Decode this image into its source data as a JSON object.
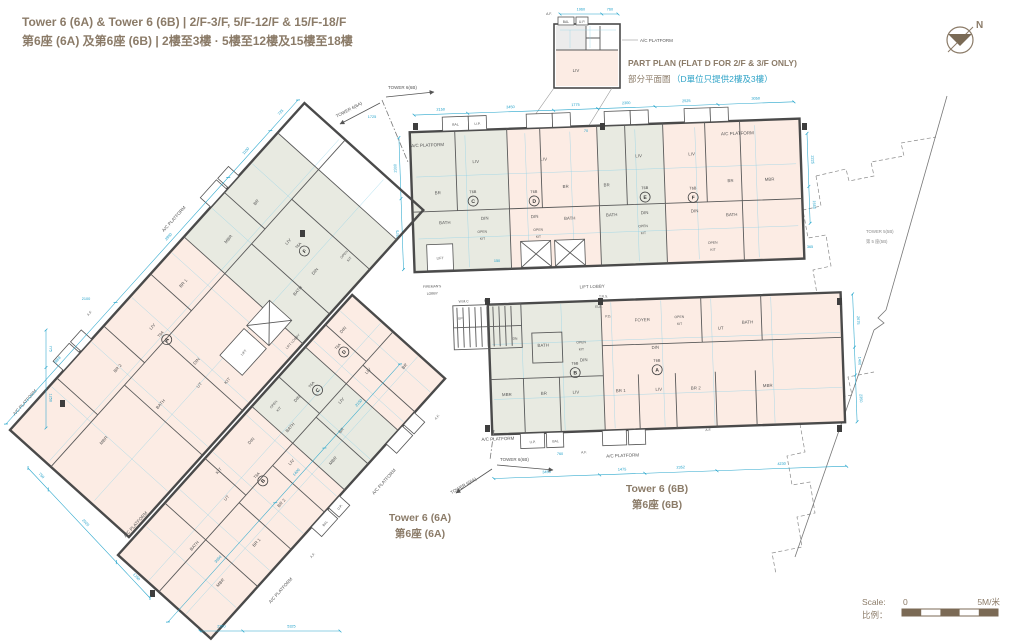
{
  "header": {
    "title_en": "Tower 6 (6A) & Tower 6 (6B) | 2/F-3/F,  5/F-12/F & 15/F-18/F",
    "title_zh": "第6座 (6A) 及第6座 (6B) | 2樓至3樓 · 5樓至12樓及15樓至18樓"
  },
  "part_plan": {
    "caption_en": "PART PLAN (FLAT D FOR 2/F & 3/F ONLY)",
    "caption_zh": "部分平面圖",
    "caption_zh_note": "（D單位只提供2樓及3樓）"
  },
  "compass": {
    "north": "N"
  },
  "towers": {
    "t6a": {
      "name_en": "Tower 6 (6A)",
      "name_zh": "第6座 (6A)",
      "code": "T6A",
      "marker": "TOWER 6(6A)",
      "units": [
        "A",
        "B",
        "C",
        "D",
        "F"
      ]
    },
    "t6b": {
      "name_en": "Tower 6 (6B)",
      "name_zh": "第6座 (6B)",
      "code": "T6B",
      "marker": "TOWER 6(6B)",
      "units": [
        "A",
        "B",
        "C",
        "D",
        "E",
        "F"
      ]
    }
  },
  "adjacent": {
    "name_en": "TOWER 5(5B)",
    "name_zh": "第 5 座(5B)"
  },
  "rooms": {
    "liv": "LIV",
    "din": "DIN",
    "br": "BR",
    "br1": "BR 1",
    "br2": "BR 2",
    "mbr": "MBR",
    "bath": "BATH",
    "open": "OPEN",
    "kit": "KIT",
    "ut": "UT",
    "foyer": "FOYER",
    "bal": "BAL",
    "up": "U.P.",
    "af": "A.F.",
    "ac": "A/C PLATFORM",
    "lift": "LIFT",
    "lift_lobby": "LIFT LOBBY",
    "fireman1": "FIREMAN'S",
    "fireman2": "LOBBY",
    "ele": "ELE.",
    "trs": "T.R.S.",
    "pd": "P.D.",
    "wmc": "W.M.C",
    "hr": "H.R.",
    "up_dir": "UP",
    "dn_dir": "DN"
  },
  "dims": {
    "c1": [
      2150,
      3450,
      1775,
      2300,
      2525,
      3050
    ],
    "c2": [
      2675,
      1400,
      2350
    ],
    "c3": [
      3450,
      1475,
      2352,
      4230
    ],
    "c4": [
      750,
      2525,
      1250
    ],
    "c5": [
      2868,
      2950,
      1100,
      725
    ],
    "c6": [
      3050,
      1400,
      2150
    ],
    "c7": [
      2675,
      2300
    ],
    "c8": [
      775,
      1250
    ],
    "c9": [
      2350,
      5325
    ],
    "c10": [
      1960,
      760
    ],
    "c11": [
      2225,
      1550
    ],
    "misc": [
      "150",
      "70",
      "365",
      "760",
      "1725",
      "2100"
    ]
  },
  "scale": {
    "label": "Scale:",
    "zero": "0",
    "five": "5M/米",
    "label_zh": "比例："
  }
}
